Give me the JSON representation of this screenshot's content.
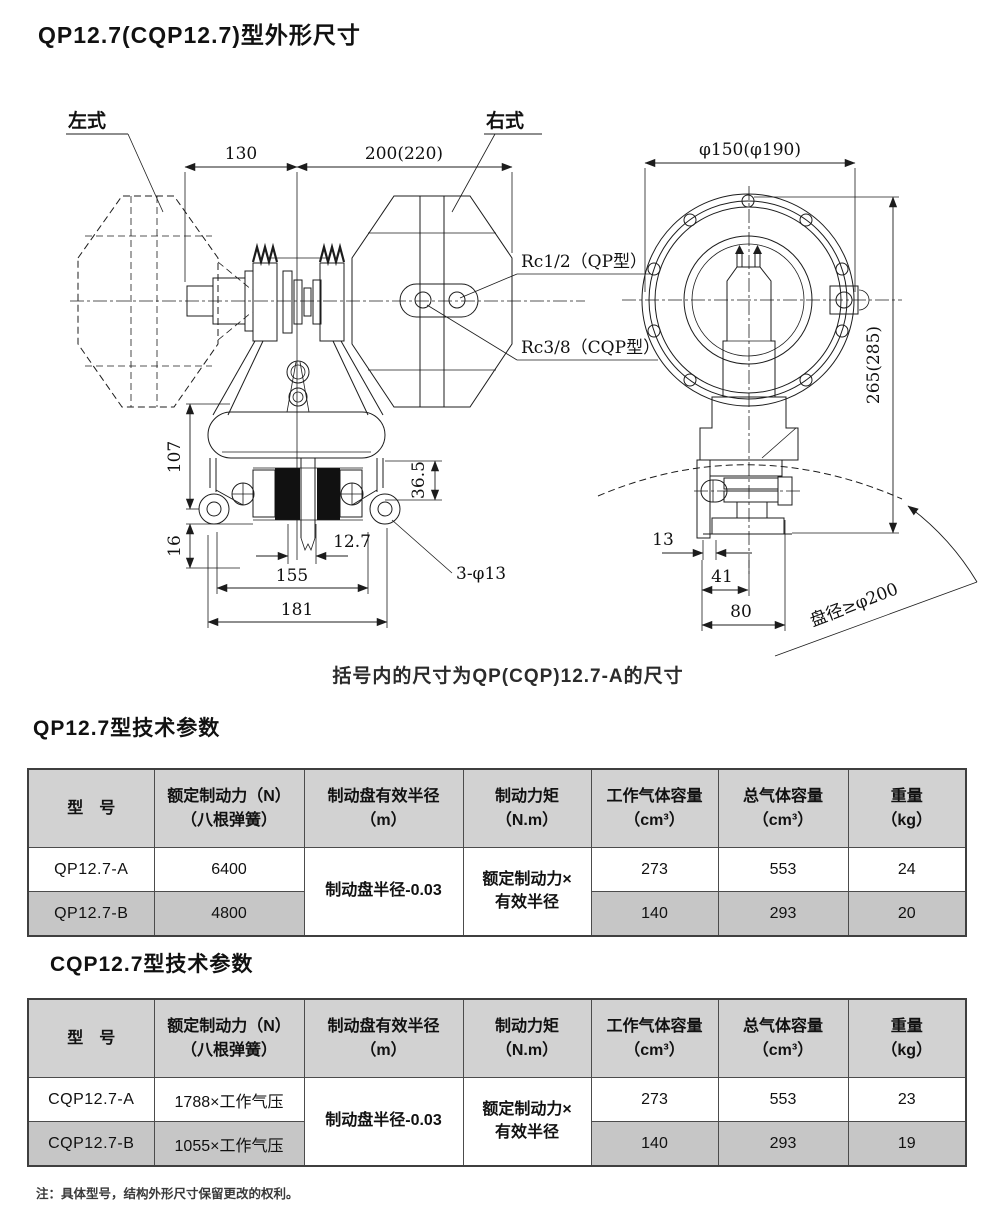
{
  "page": {
    "title": "QP12.7(CQP12.7)型外形尺寸",
    "drawing_note": "括号内的尺寸为QP(CQP)12.7-A的尺寸",
    "footnote": "注：具体型号，结构外形尺寸保留更改的权利。"
  },
  "drawing": {
    "label_left": "左式",
    "label_right": "右式",
    "dim_130": "130",
    "dim_200_220": "200(220)",
    "port_qp": "Rc1/2（QP型）",
    "port_cqp": "Rc3/8（CQP型）",
    "dim_107": "107",
    "dim_36_5": "36.5",
    "dim_16": "16",
    "dim_12_7": "12.7",
    "dim_155": "155",
    "dim_181": "181",
    "dim_3_phi13": "3-φ13",
    "dim_phi150": "φ150(φ190)",
    "dim_265_285": "265(285)",
    "dim_13": "13",
    "dim_41": "41",
    "dim_80": "80",
    "disc_note": "盘径≥φ200"
  },
  "spec_tables": [
    {
      "title": "QP12.7型技术参数",
      "headers": [
        {
          "l1": "型　号",
          "l2": ""
        },
        {
          "l1": "额定制动力（N）",
          "l2": "（八根弹簧）"
        },
        {
          "l1": "制动盘有效半径",
          "l2": "（m）"
        },
        {
          "l1": "制动力矩",
          "l2": "（N.m）"
        },
        {
          "l1": "工作气体容量",
          "l2": "（cm³）"
        },
        {
          "l1": "总气体容量",
          "l2": "（cm³）"
        },
        {
          "l1": "重量",
          "l2": "（kg）"
        }
      ],
      "radius_merged": "制动盘半径-0.03",
      "torque_merged_l1": "额定制动力×",
      "torque_merged_l2": "有效半径",
      "rows": [
        {
          "model": "QP12.7-A",
          "force": "6400",
          "work": "273",
          "total": "553",
          "weight": "24"
        },
        {
          "model": "QP12.7-B",
          "force": "4800",
          "work": "140",
          "total": "293",
          "weight": "20"
        }
      ]
    },
    {
      "title": "CQP12.7型技术参数",
      "headers": [
        {
          "l1": "型　号",
          "l2": ""
        },
        {
          "l1": "额定制动力（N）",
          "l2": "（八根弹簧）"
        },
        {
          "l1": "制动盘有效半径",
          "l2": "（m）"
        },
        {
          "l1": "制动力矩",
          "l2": "（N.m）"
        },
        {
          "l1": "工作气体容量",
          "l2": "（cm³）"
        },
        {
          "l1": "总气体容量",
          "l2": "（cm³）"
        },
        {
          "l1": "重量",
          "l2": "（kg）"
        }
      ],
      "radius_merged": "制动盘半径-0.03",
      "torque_merged_l1": "额定制动力×",
      "torque_merged_l2": "有效半径",
      "rows": [
        {
          "model": "CQP12.7-A",
          "force": "1788×工作气压",
          "work": "273",
          "total": "553",
          "weight": "23"
        },
        {
          "model": "CQP12.7-B",
          "force": "1055×工作气压",
          "work": "140",
          "total": "293",
          "weight": "19"
        }
      ]
    }
  ]
}
